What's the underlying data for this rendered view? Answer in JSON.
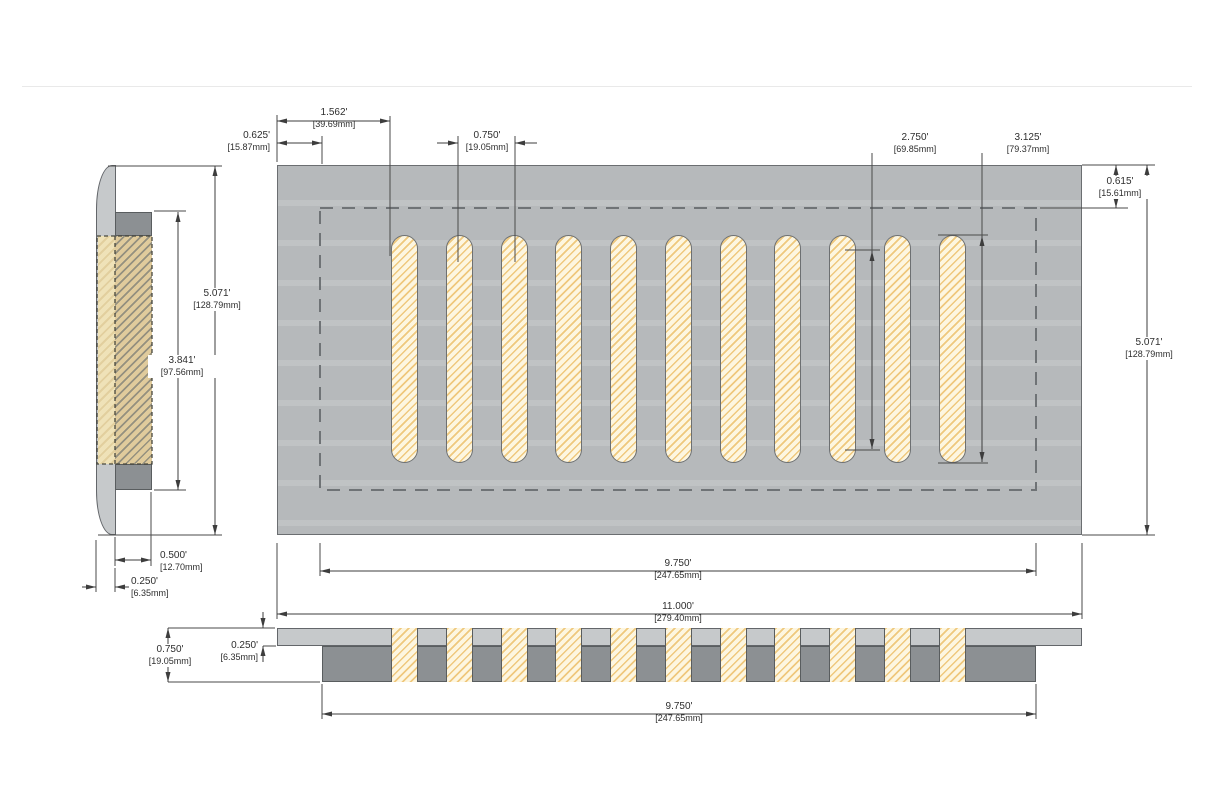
{
  "drawing": {
    "type": "technical-dimension-drawing",
    "subject": "slotted vent register, three orthographic views",
    "slot_count": 11
  },
  "colors": {
    "plate_gray": "#b6b9bb",
    "plate_light_gray": "#c6c9cb",
    "dark_gray": "#8c9093",
    "outline": "#6b6e71",
    "hatch_cream": "#fdf6e0",
    "hatch_orange": "#efc87d",
    "hatch_tan": "#e0cb9c",
    "dim_line": "#3d3d3d",
    "dashed_line": "#6f7376"
  },
  "dims": {
    "slot_offset_left": {
      "in": "1.562'",
      "mm": "[39.69mm]"
    },
    "margin_left": {
      "in": "0.625'",
      "mm": "[15.87mm]"
    },
    "slot_pitch": {
      "in": "0.750'",
      "mm": "[19.05mm]"
    },
    "slot_straight_length": {
      "in": "2.750'",
      "mm": "[69.85mm]"
    },
    "slot_full_length": {
      "in": "3.125'",
      "mm": "[79.37mm]"
    },
    "margin_top": {
      "in": "0.615'",
      "mm": "[15.61mm]"
    },
    "overall_depth": {
      "in": "5.071'",
      "mm": "[128.79mm]"
    },
    "opening_width_top": {
      "in": "9.750'",
      "mm": "[247.65mm]"
    },
    "overall_width": {
      "in": "11.000'",
      "mm": "[279.40mm]"
    },
    "side_overall_height": {
      "in": "5.071'",
      "mm": "[128.79mm]"
    },
    "side_opening_height": {
      "in": "3.841'",
      "mm": "[97.56mm]"
    },
    "box_depth": {
      "in": "0.500'",
      "mm": "[12.70mm]"
    },
    "plate_thickness_side": {
      "in": "0.250'",
      "mm": "[6.35mm]"
    },
    "front_total_height": {
      "in": "0.750'",
      "mm": "[19.05mm]"
    },
    "front_plate_thickness": {
      "in": "0.250'",
      "mm": "[6.35mm]"
    },
    "front_opening_width": {
      "in": "9.750'",
      "mm": "[247.65mm]"
    }
  }
}
